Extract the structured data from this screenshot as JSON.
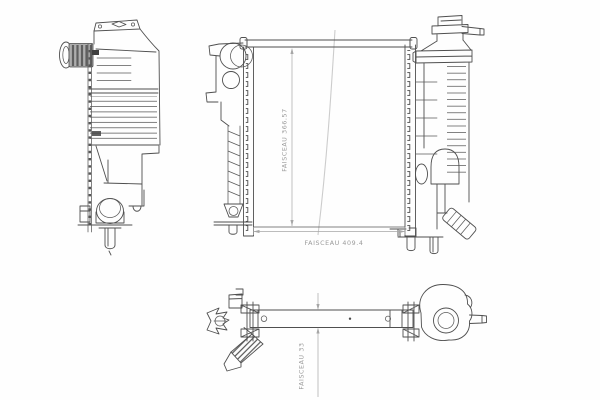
{
  "drawing": {
    "subject": "radiator technical line drawing",
    "background_color": "#fefefe",
    "line_color": "#4f4f4f",
    "crease_color": "#cccccc",
    "annotation_color": "#9a9a9a",
    "hose_fill_color": "#adadad"
  },
  "annotations": {
    "core_height_label": "FAISCEAU 366.57",
    "core_width_label": "FAISCEAU 409.4",
    "core_depth_label": "FAISCEAU 33"
  }
}
